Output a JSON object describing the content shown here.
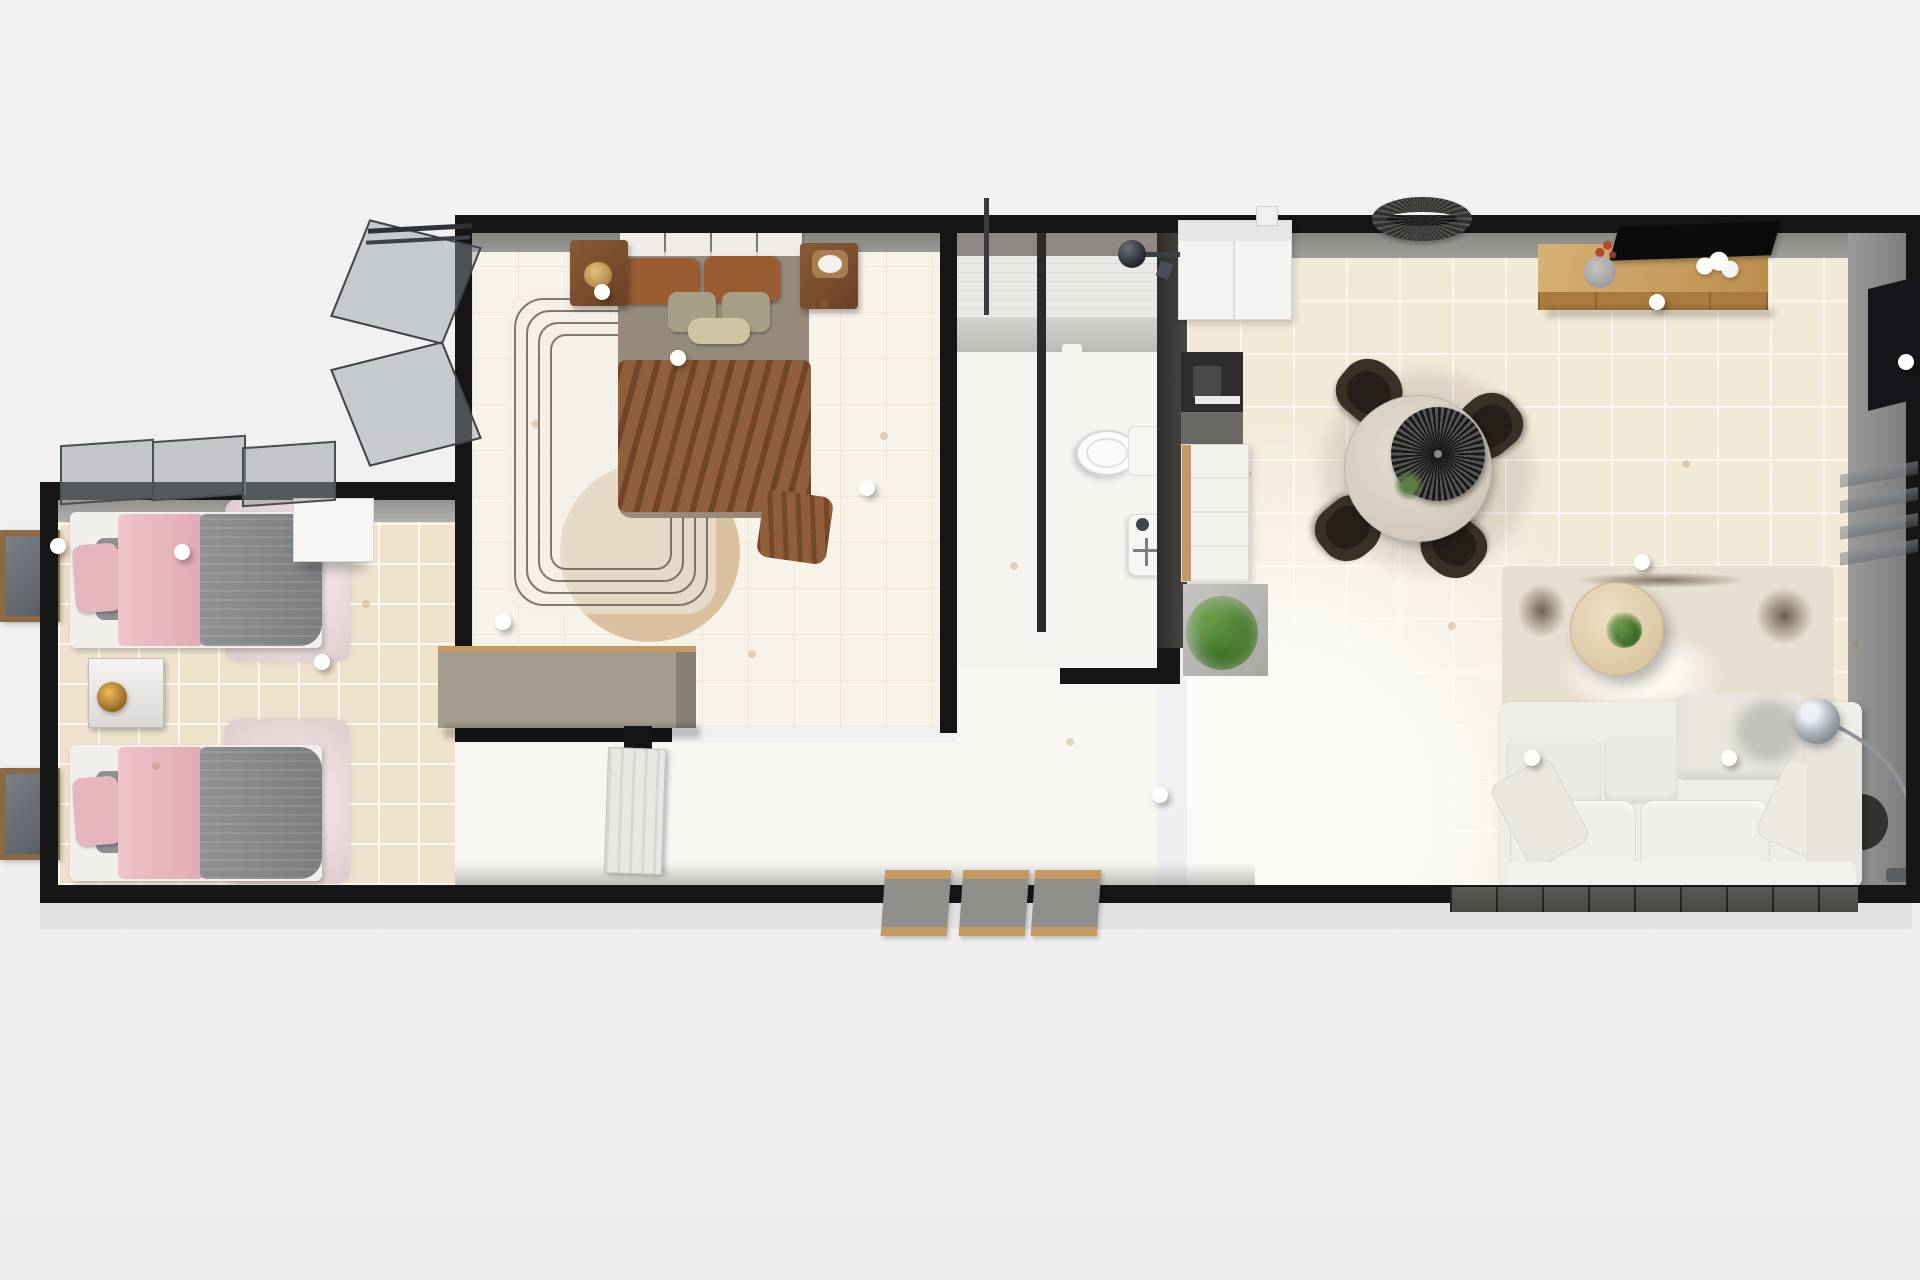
{
  "scene": {
    "kind": "3d-floor-plan-top-view",
    "description": "Rendered top-down 3D floor plan of a single-storey park home with twin bedroom, master bedroom, shower room, galley kitchen and open-plan living-dining room",
    "rooms": [
      {
        "id": "twin-bedroom",
        "label": "Twin Bedroom",
        "furniture": [
          "twin-bed-1",
          "twin-bed-2",
          "fur-rug-1",
          "fur-rug-2",
          "nightstand-with-lamp",
          "wardrobe-shelf",
          "leaning-mirror-1",
          "leaning-mirror-2",
          "open-window"
        ]
      },
      {
        "id": "master-bedroom",
        "label": "Master Bedroom",
        "furniture": [
          "double-bed",
          "nightstand-left",
          "nightstand-right",
          "patterned-rug",
          "round-tan-rug",
          "dresser",
          "open-window"
        ]
      },
      {
        "id": "hallway",
        "label": "Hallway / Entry",
        "furniture": [
          "interior-door",
          "entry-step-mats"
        ]
      },
      {
        "id": "shower-room",
        "label": "Shower Room",
        "furniture": [
          "walk-in-shower",
          "shower-glass-screen",
          "toilet",
          "wash-basin"
        ]
      },
      {
        "id": "kitchen",
        "label": "Kitchen",
        "furniture": [
          "fridge",
          "cooktop-unit",
          "counter-cabinet",
          "concrete-platform",
          "potted-plant"
        ]
      },
      {
        "id": "living-dining",
        "label": "Living / Dining Room",
        "furniture": [
          "rattan-pendant-light",
          "wall-tv",
          "media-console",
          "vase-with-coral-stems",
          "white-coral-decor",
          "round-dining-table",
          "dark-serving-tray",
          "dining-chair-x4",
          "abstract-area-rug",
          "round-coffee-table",
          "white-sofa",
          "arc-floor-lamp",
          "dark-wall-panel",
          "glass-shelf-unit",
          "dark-side-table",
          "potted-plant"
        ]
      }
    ],
    "ceiling_lights_count": 13,
    "entry_steps_count": 3
  },
  "colors": {
    "wall": "#161616",
    "floorTile": "#f3e9d7",
    "twinTile": "#efe2cd",
    "masterFloor": "#f8f3e9",
    "bathFloor": "#f6f4f1",
    "hallFloor": "#f8f6f3",
    "tanCircle": "#d8c0a0",
    "bedPink": "#e5b6bd",
    "masterDuvet": "#968a7b",
    "rustBlanket": "#8a5531",
    "rustPillow": "#9a5c31",
    "sage": "#a79e86",
    "woodLight": "#c59a62",
    "chair": "#393026",
    "sofa": "#efede8"
  }
}
